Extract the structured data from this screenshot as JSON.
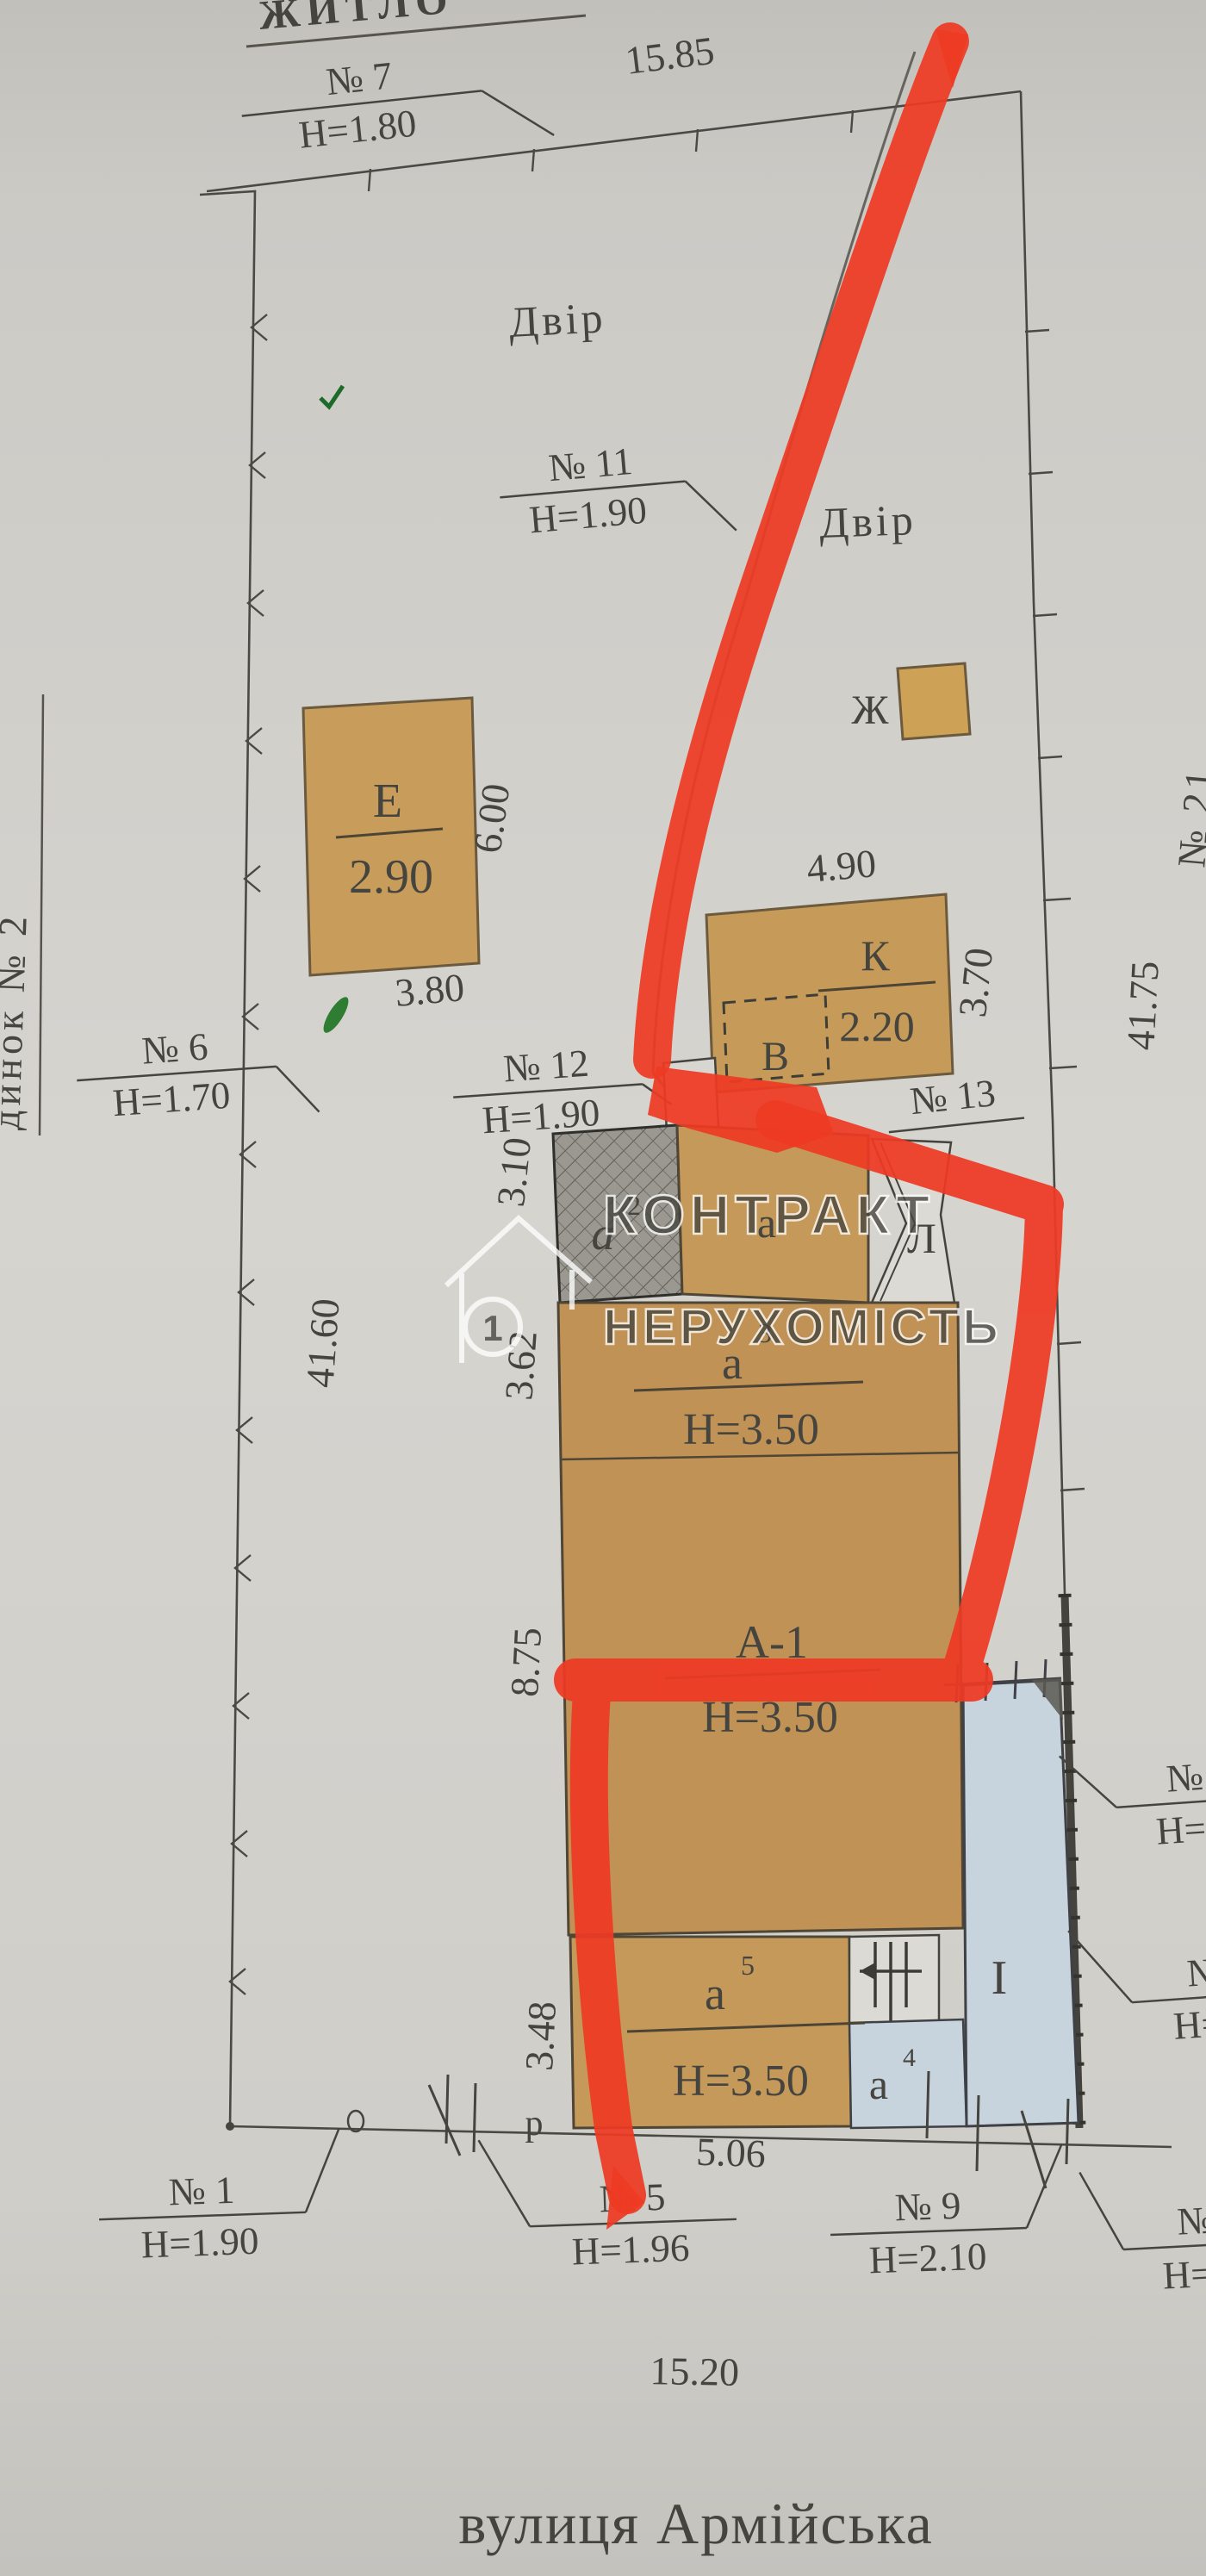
{
  "document": {
    "street_name": "вулиця Армійська",
    "top_edge_fragment": "ЖИТЛО",
    "left_edge_fragment": "динок № 2",
    "right_edge_fragment": "№ 21",
    "courtyard_label_1": "Двір",
    "courtyard_label_2": "Двір"
  },
  "watermark": {
    "line1": "КОНТРАКТ",
    "line2": "НЕРУХОМІСТЬ",
    "badge": "1"
  },
  "fences": {
    "n7": {
      "no": "№ 7",
      "h": "Н=1.80"
    },
    "n11": {
      "no": "№ 11",
      "h": "Н=1.90"
    },
    "n6": {
      "no": "№ 6",
      "h": "Н=1.70"
    },
    "n12": {
      "no": "№ 12",
      "h": "Н=1.90"
    },
    "n13": {
      "no": "№ 13"
    },
    "n1": {
      "no": "№ 1",
      "h": "Н=1.90"
    },
    "n5": {
      "no": "№ 5",
      "h": "Н=1.96"
    },
    "n9": {
      "no": "№ 9",
      "h": "Н=2.10"
    },
    "right_upper": {
      "no": "№",
      "h": "Н="
    },
    "right_mid": {
      "no": "№",
      "h": "Н="
    },
    "right_lower": {
      "no": "№",
      "h": "Н=2"
    }
  },
  "dimensions": {
    "top_width": "15.85",
    "left_length": "41.60",
    "right_length": "41.75",
    "street_width": "15.20",
    "e_width": "3.80",
    "e_height": "6.00",
    "k_width": "4.90",
    "k_depth": "3.70",
    "a2_depth": "3.10",
    "a3_depth": "3.62",
    "a1_depth": "8.75",
    "a5_depth": "3.48",
    "a5_width": "5.06"
  },
  "buildings": {
    "e": {
      "label": "Е",
      "value": "2.90"
    },
    "zh": {
      "label": "Ж"
    },
    "k": {
      "label": "К",
      "value": "2.20"
    },
    "v": {
      "label": "В"
    },
    "a2": {
      "base": "а",
      "sup": "2"
    },
    "a_porch": {
      "label": "а"
    },
    "l": {
      "label": "Л"
    },
    "a3": {
      "base": "а",
      "sup": "3",
      "height": "Н=3.50"
    },
    "a1": {
      "label": "А-1",
      "height": "Н=3.50"
    },
    "a5": {
      "base": "а",
      "sup": "5",
      "height": "Н=3.50"
    },
    "a4": {
      "base": "а",
      "sup": "4"
    },
    "i": {
      "label": "І"
    },
    "gate": {
      "label": "р"
    }
  },
  "colors": {
    "paper": "#d2d0cb",
    "tan_building": "#c49959",
    "hatched_building": "#9a9890",
    "blue_building": "#c7d4dd",
    "red_marker": "#ee3a24",
    "ink": "#45443e",
    "green_mark": "#2e7d32",
    "watermark": "#ffffff"
  }
}
